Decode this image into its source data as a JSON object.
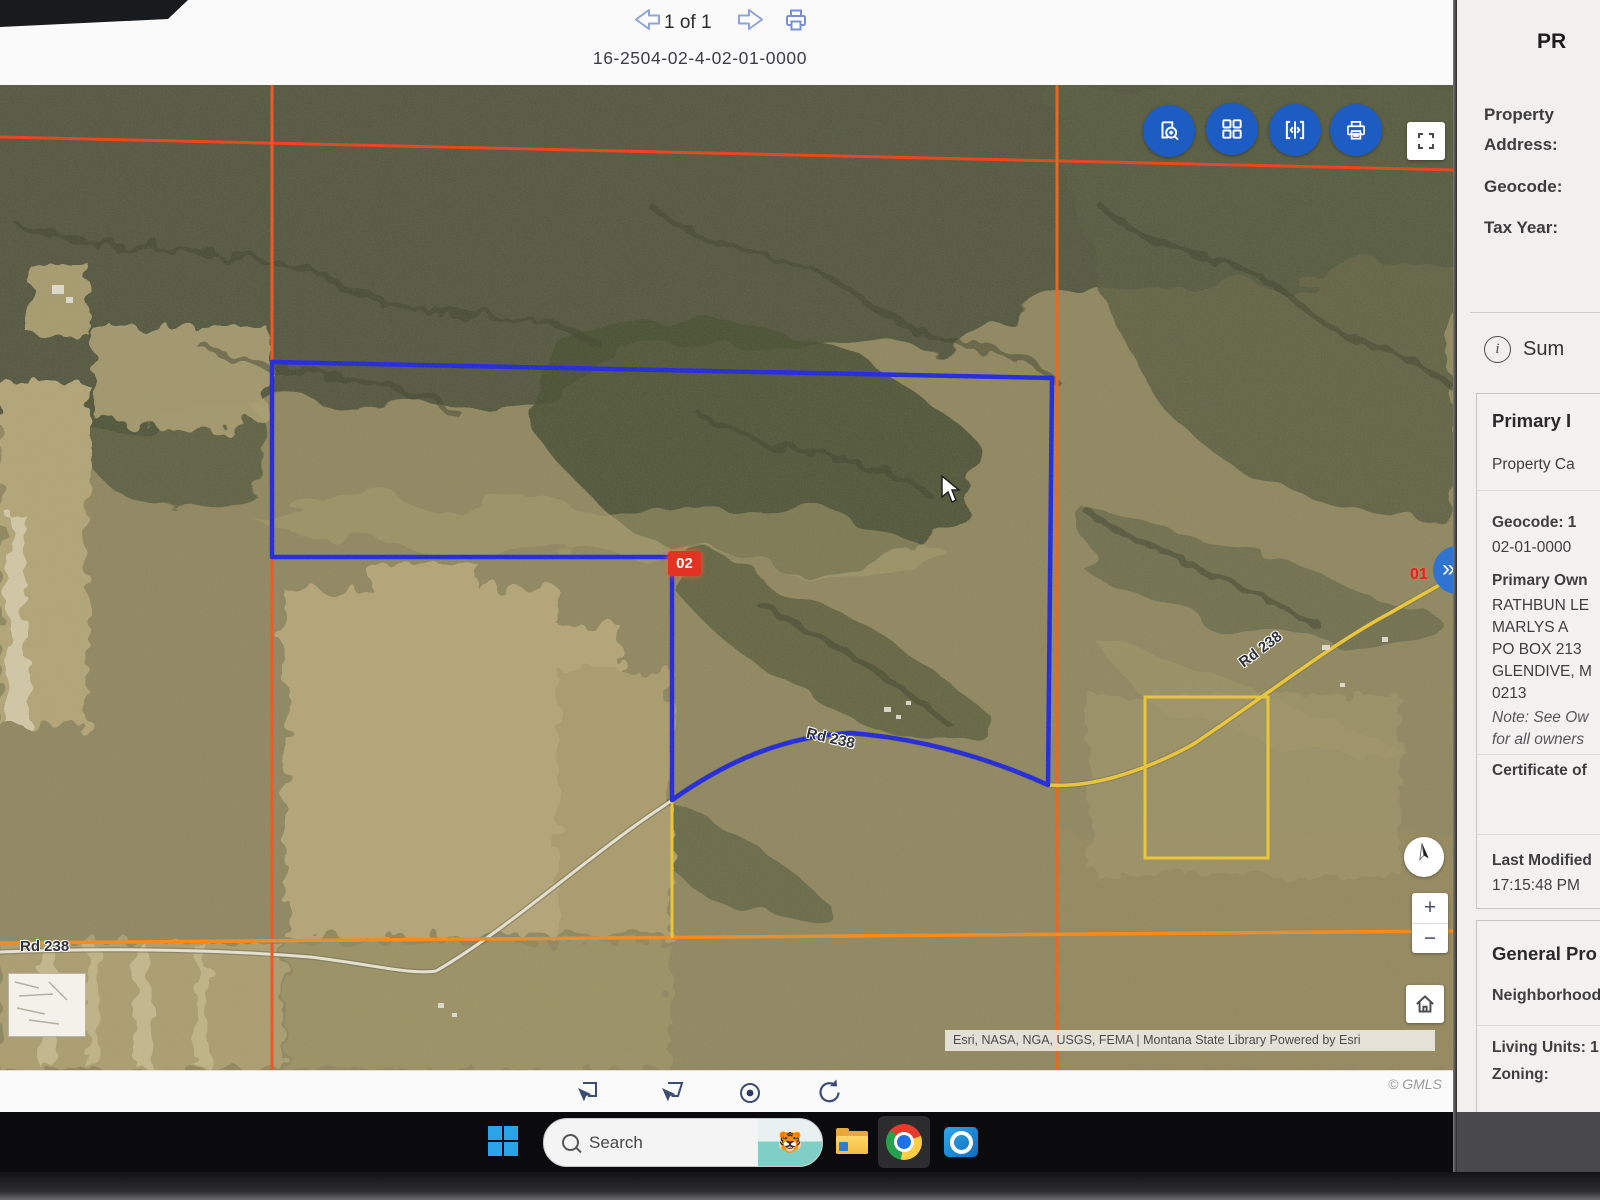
{
  "top_bar": {
    "pager_label": "1 of 1",
    "parcel_id": "16-2504-02-4-02-01-0000"
  },
  "map": {
    "attribution": "Esri, NASA, NGA, USGS, FEMA | Montana State Library   Powered by Esri",
    "labels": {
      "parcel_02": "02",
      "parcel_01": "01",
      "road_main": "Rd 238",
      "road_east": "Rd 238",
      "road_west": "Rd 238"
    },
    "controls": {
      "zoom_in": "+",
      "zoom_out": "−",
      "expand": "»",
      "info_icon": "i"
    },
    "colors": {
      "selected_parcel": "#1c23e0",
      "section_line": "#ee4418",
      "adjacent_parcel": "#eec832",
      "tool_button": "#1d5cc2"
    }
  },
  "footer_toolbar": {
    "copyright": "© GMLS"
  },
  "taskbar": {
    "search_label": "Search",
    "tiger_icon": "🐯"
  },
  "sidebar": {
    "header_title": "PR",
    "property_address_label": "Property Address:",
    "geocode_label": "Geocode:",
    "tax_year_label": "Tax Year:",
    "summary_title": "Sum",
    "primary_card": {
      "title": "Primary I",
      "property_category_label": "Property Ca",
      "geocode_line1": "Geocode: 1",
      "geocode_line2": "02-01-0000",
      "owner_label": "Primary Own",
      "owner_lines": [
        "RATHBUN LE",
        "MARLYS A",
        "PO BOX 213",
        "GLENDIVE, M",
        "0213"
      ],
      "owner_note_line1": "Note: See Ow",
      "owner_note_line2": "for all owners",
      "certificate_label": "Certificate of",
      "last_modified_label": "Last Modified",
      "last_modified_value": "17:15:48 PM"
    },
    "general_card": {
      "title": "General Pro",
      "neighborhood_label": "Neighborhood",
      "living_units_label": "Living Units: 1",
      "zoning_label": "Zoning:"
    }
  }
}
